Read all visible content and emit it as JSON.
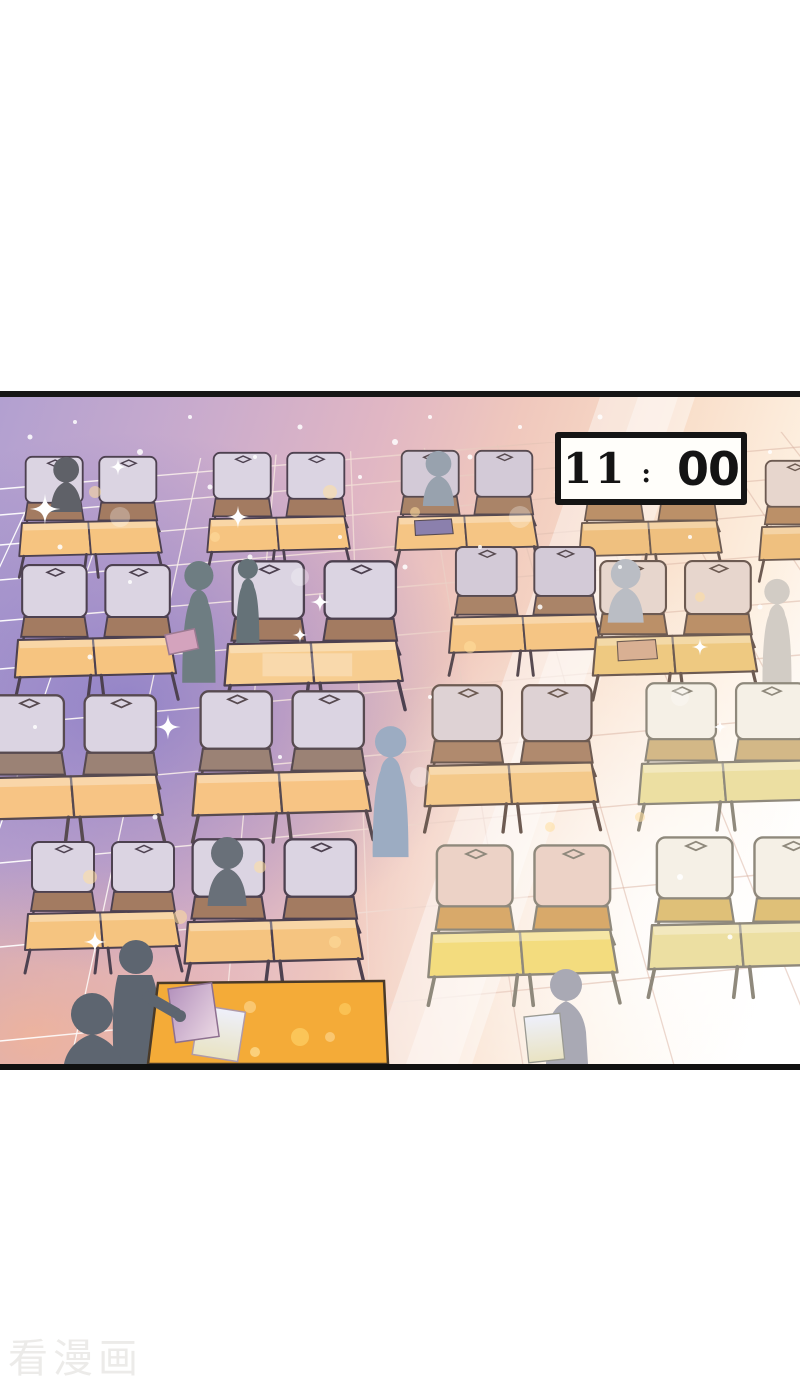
{
  "panel": {
    "clock": {
      "hours": "11",
      "separator": ":",
      "minutes": "00"
    },
    "scene_colors": {
      "floor_purple": "#8e87c8",
      "floor_pink": "#eec6bd",
      "floor_white": "#ffffff",
      "desk_orange": "#f6c480",
      "desk_pale_yellow": "#ecdfa2",
      "chair_lavender": "#dbd4e2",
      "seat_brown": "#a37b61",
      "outline_dark": "#4d4150",
      "figure_gray": "#6e7d82",
      "figure_blue_gray": "#9cacc2",
      "teacher_desk_orange": "#f4ab38",
      "sparkle_yellow": "#ffdf9e",
      "clock_border": "#151515",
      "clock_face": "#fffefa"
    }
  },
  "watermark": {
    "text": "看漫画",
    "color": "#ecebe9"
  }
}
